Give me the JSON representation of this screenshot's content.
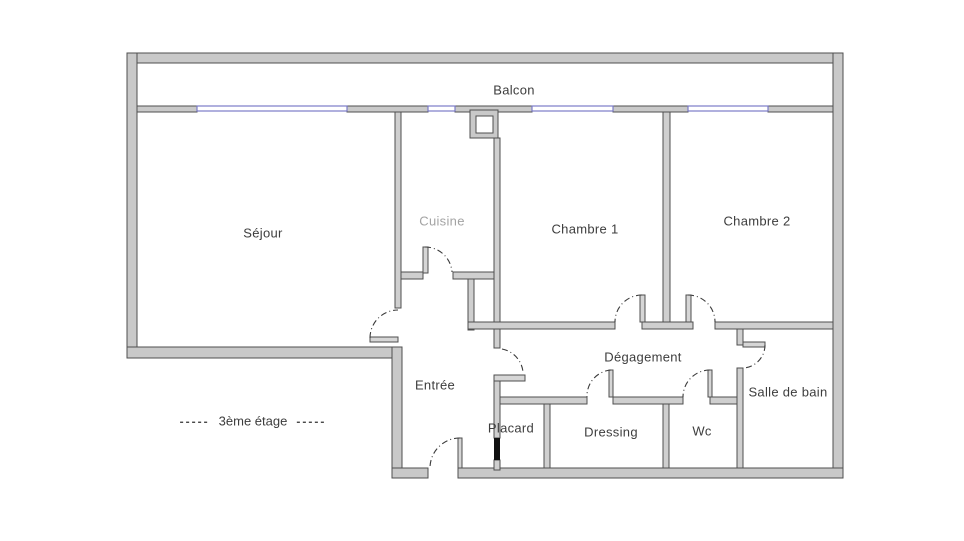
{
  "rooms": {
    "balcon": {
      "label": "Balcon"
    },
    "sejour": {
      "label": "Séjour"
    },
    "cuisine": {
      "label": "Cuisine"
    },
    "chambre1": {
      "label": "Chambre 1"
    },
    "chambre2": {
      "label": "Chambre 2"
    },
    "entree": {
      "label": "Entrée"
    },
    "degagement": {
      "label": "Dégagement"
    },
    "salle_de_bain": {
      "label": "Salle de bain"
    },
    "placard": {
      "label": "Placard"
    },
    "dressing": {
      "label": "Dressing"
    },
    "wc": {
      "label": "Wc"
    }
  },
  "floor_note": {
    "left_dashes": "-----",
    "text": "3ème étage",
    "right_dashes": "-----"
  },
  "colors": {
    "background": "#ffffff",
    "wall_fill": "#c9c9c9",
    "wall_stroke": "#4f4f4f",
    "window_blue": "#7b7bc8",
    "door_arc": "#3a3a3a",
    "label_text": "#3d3d3d",
    "cuisine_label_text": "#a3a3a3",
    "placard_door": "#111111"
  }
}
